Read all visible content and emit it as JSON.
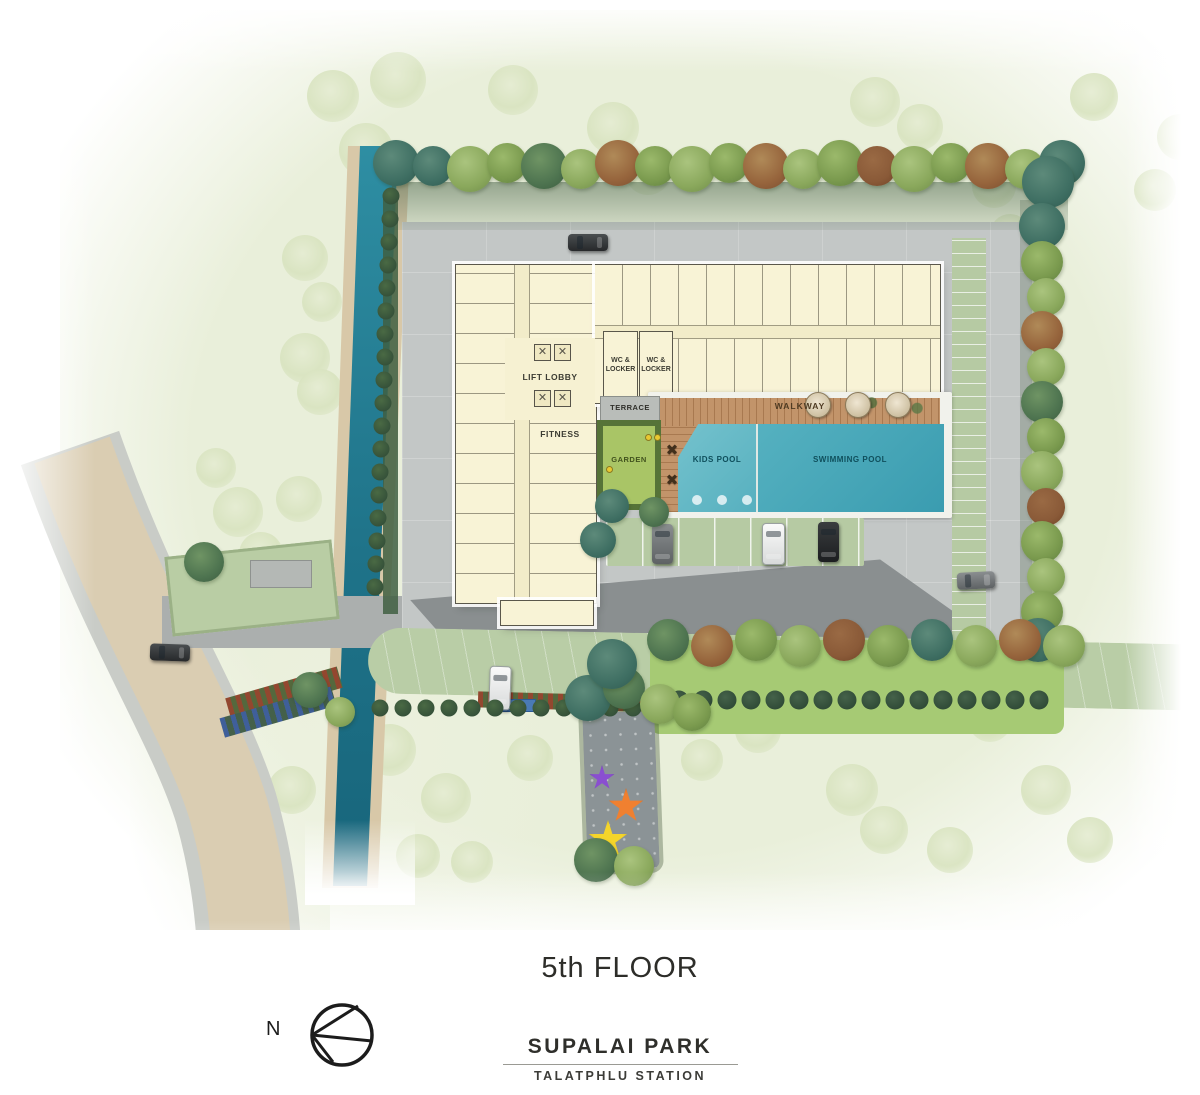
{
  "meta": {
    "floor_title": "5th FLOOR"
  },
  "branding": {
    "project_name": "SUPALAI PARK",
    "project_subtitle": "TALATPHLU STATION"
  },
  "compass": {
    "north_label": "N"
  },
  "plan_labels": {
    "lift_lobby": "LIFT LOBBY",
    "fitness": "FITNESS",
    "wc_locker": "WC & LOCKER",
    "terrace": "TERRACE",
    "walkway": "WALKWAY",
    "garden": "GARDEN",
    "kids_pool": "KIDS POOL",
    "swimming_pool": "SWIMMING POOL"
  },
  "icons": {
    "elevator": "✕",
    "pool_table": "✖"
  },
  "colors": {
    "canal": "#267f95",
    "swimming_pool": "#3fa3b5",
    "kids_pool": "#63b9c6",
    "building": "#f8f3d6",
    "walkway_wood": "#c2946a",
    "garden": "#a9c566",
    "lawn": "#a6ca74",
    "paver_green": "#b6caa3",
    "road_gray": "#c3c7c6",
    "asphalt": "#8a8f90",
    "main_road_beige": "#dacdb2",
    "star_purple": "#8a4fd0",
    "star_orange": "#f08030",
    "star_yellow": "#f5d52a"
  }
}
